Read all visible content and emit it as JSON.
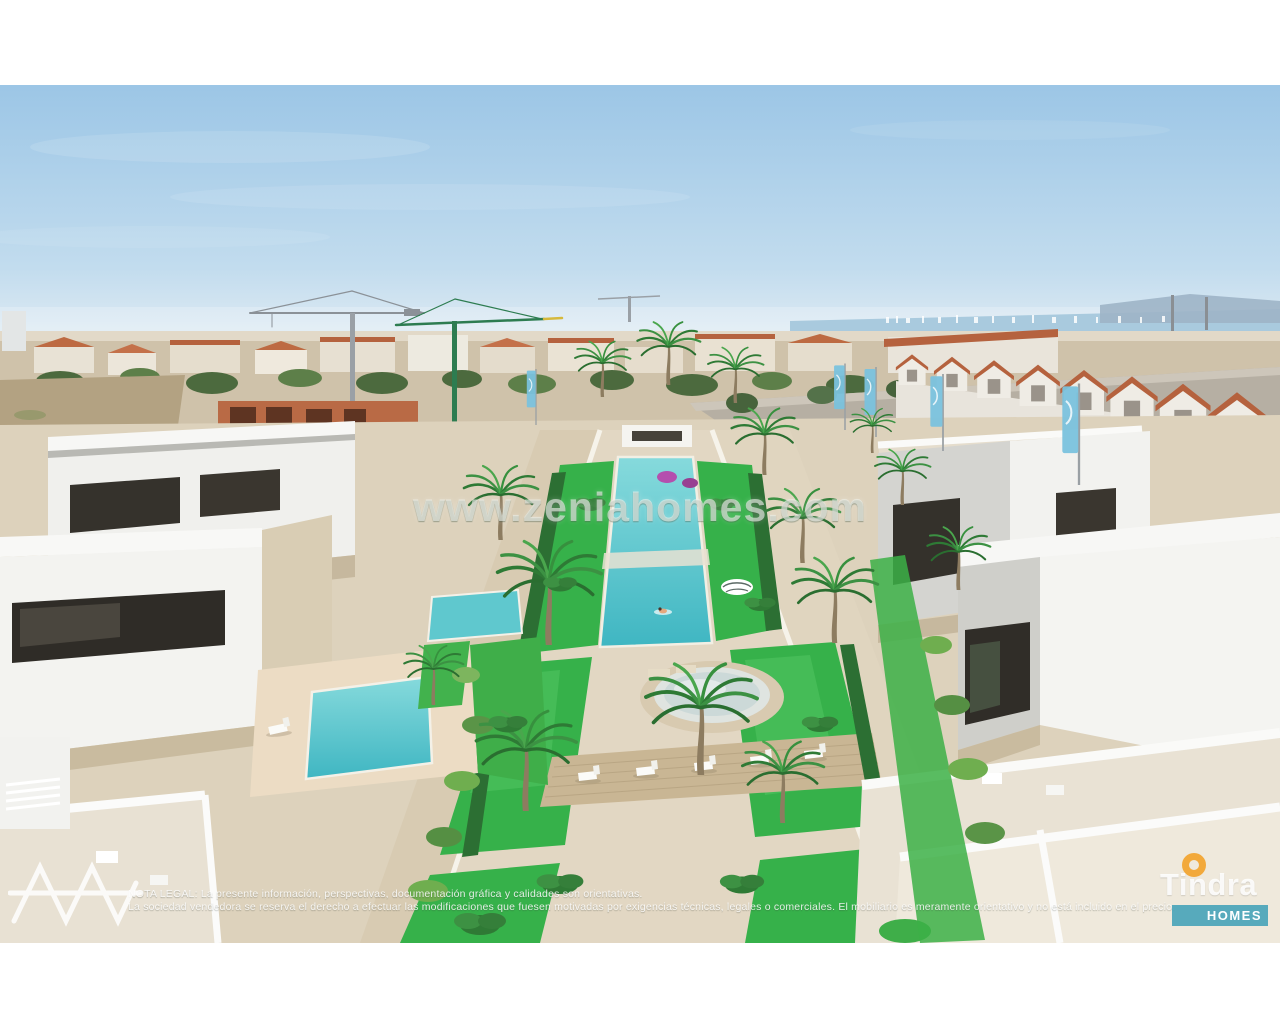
{
  "photo": {
    "description": "Aerial 3D architectural render of a development of modern white flat-roofed villas with private plunge pools, arranged around a central communal garden with palm trees, a long turquoise pool, a round plunge pool and sun loungers on a wooden deck; construction cranes, a town with terracotta roofs and the Mar Menor sea on the horizon"
  },
  "watermark": {
    "text": "www.zeniahomes.com"
  },
  "legal": {
    "line1": "NOTA LEGAL: La presente información, perspectivas, documentación gráfica y calidades son orientativas.",
    "line2": "La sociedad vendedora se reserva el derecho a efectuar las modificaciones que fuesen motivadas por exigencias técnicas, legales o comerciales. El mobiliario es meramente orientativo y no está incluido en el precio."
  },
  "branding": {
    "developer_name": "Tindra",
    "developer_tagline": "HOMES",
    "colors": {
      "homes_bar": "#4aa4b9",
      "ring": "#f2a93b"
    }
  },
  "scene_colors": {
    "sky": "#9cc6e6",
    "sea": "#a9cade",
    "lawn": "#36b14a",
    "pool_water": "#5ec8ce",
    "terracotta_roof": "#b5623e",
    "sand_path": "#e2d7c3",
    "villa_white": "#f3f3f0"
  }
}
